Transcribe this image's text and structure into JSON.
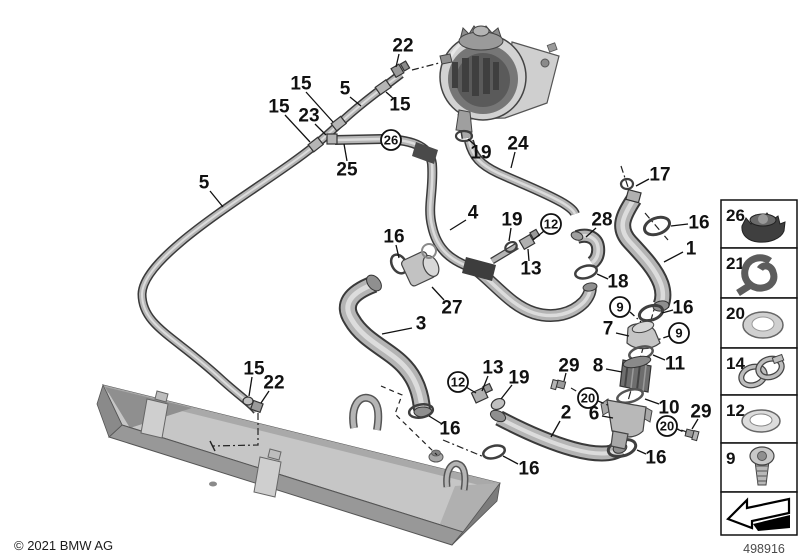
{
  "footer": {
    "copyright": "© 2021 BMW AG",
    "diagram_number": "498916"
  },
  "sidebar": {
    "items": [
      {
        "number": "26",
        "part_icon": "sealing-cap-icon"
      },
      {
        "number": "21",
        "part_icon": "hose-wrap-icon"
      },
      {
        "number": "20",
        "part_icon": "gasket-ring-icon"
      },
      {
        "number": "14",
        "part_icon": "hose-clamp-icon"
      },
      {
        "number": "12",
        "part_icon": "o-ring-icon"
      },
      {
        "number": "9",
        "part_icon": "torx-screw-icon"
      }
    ],
    "nav_arrow_icon": "previous-diagram-arrow-icon"
  },
  "diagram": {
    "callouts": [
      {
        "t": "22",
        "x": 403,
        "y": 46,
        "l": [
          399,
          54,
          396,
          67
        ]
      },
      {
        "t": "15",
        "x": 301,
        "y": 84,
        "l": [
          306,
          92,
          333,
          122
        ]
      },
      {
        "t": "5",
        "x": 345,
        "y": 89,
        "l": [
          350,
          97,
          361,
          106
        ]
      },
      {
        "t": "15",
        "x": 400,
        "y": 105,
        "l": [
          394,
          99,
          386,
          92
        ]
      },
      {
        "t": "15",
        "x": 279,
        "y": 107,
        "l": [
          285,
          115,
          310,
          142
        ]
      },
      {
        "t": "23",
        "x": 309,
        "y": 116,
        "l": [
          315,
          124,
          326,
          135
        ]
      },
      {
        "t": "26",
        "x": 391,
        "y": 140,
        "c": true
      },
      {
        "t": "25",
        "x": 347,
        "y": 170,
        "l": [
          347,
          161,
          344,
          144
        ]
      },
      {
        "t": "5",
        "x": 204,
        "y": 183,
        "l": [
          210,
          191,
          223,
          207
        ]
      },
      {
        "t": "19",
        "x": 481,
        "y": 153,
        "l": [
          476,
          146,
          468,
          139
        ]
      },
      {
        "t": "24",
        "x": 518,
        "y": 144,
        "l": [
          515,
          152,
          511,
          168
        ]
      },
      {
        "t": "17",
        "x": 660,
        "y": 175,
        "l": [
          649,
          179,
          636,
          186
        ]
      },
      {
        "t": "4",
        "x": 473,
        "y": 213,
        "l": [
          466,
          220,
          450,
          230
        ]
      },
      {
        "t": "19",
        "x": 512,
        "y": 220,
        "l": [
          511,
          228,
          509,
          241
        ]
      },
      {
        "t": "12",
        "x": 551,
        "y": 224,
        "c": true,
        "l": [
          544,
          231,
          533,
          240
        ]
      },
      {
        "t": "28",
        "x": 602,
        "y": 220,
        "l": [
          596,
          228,
          586,
          237
        ]
      },
      {
        "t": "16",
        "x": 699,
        "y": 223,
        "l": [
          688,
          224,
          671,
          226
        ]
      },
      {
        "t": "1",
        "x": 691,
        "y": 249,
        "l": [
          683,
          252,
          664,
          262
        ]
      },
      {
        "t": "13",
        "x": 531,
        "y": 269,
        "l": [
          529,
          261,
          528,
          249
        ]
      },
      {
        "t": "18",
        "x": 618,
        "y": 282,
        "l": [
          608,
          279,
          597,
          274
        ]
      },
      {
        "t": "16",
        "x": 394,
        "y": 237,
        "l": [
          396,
          245,
          399,
          258
        ]
      },
      {
        "t": "27",
        "x": 452,
        "y": 308,
        "l": [
          444,
          300,
          432,
          287
        ]
      },
      {
        "t": "9",
        "x": 620,
        "y": 307,
        "c": true,
        "d": [
          630,
          312,
          641,
          322
        ]
      },
      {
        "t": "16",
        "x": 683,
        "y": 308,
        "l": [
          673,
          310,
          662,
          313
        ]
      },
      {
        "t": "7",
        "x": 608,
        "y": 329,
        "l": [
          616,
          333,
          629,
          336
        ]
      },
      {
        "t": "9",
        "x": 679,
        "y": 333,
        "c": true,
        "d": [
          669,
          336,
          657,
          340
        ]
      },
      {
        "t": "3",
        "x": 421,
        "y": 324,
        "l": [
          412,
          328,
          382,
          334
        ]
      },
      {
        "t": "29",
        "x": 569,
        "y": 366,
        "l": [
          566,
          373,
          564,
          381
        ]
      },
      {
        "t": "8",
        "x": 598,
        "y": 366,
        "l": [
          606,
          369,
          622,
          372
        ]
      },
      {
        "t": "11",
        "x": 675,
        "y": 364,
        "l": [
          665,
          360,
          653,
          355
        ]
      },
      {
        "t": "20",
        "x": 588,
        "y": 398,
        "c": true,
        "d": [
          598,
          401,
          610,
          406
        ]
      },
      {
        "t": "10",
        "x": 669,
        "y": 408,
        "l": [
          659,
          404,
          645,
          399
        ]
      },
      {
        "t": "2",
        "x": 566,
        "y": 413,
        "l": [
          560,
          421,
          551,
          437
        ]
      },
      {
        "t": "6",
        "x": 594,
        "y": 414,
        "l": [
          602,
          416,
          613,
          418
        ]
      },
      {
        "t": "29",
        "x": 701,
        "y": 412,
        "l": [
          698,
          419,
          692,
          429
        ]
      },
      {
        "t": "20",
        "x": 667,
        "y": 426,
        "c": true,
        "d": [
          677,
          429,
          686,
          433
        ]
      },
      {
        "t": "16",
        "x": 656,
        "y": 458,
        "l": [
          646,
          454,
          637,
          450
        ]
      },
      {
        "t": "15",
        "x": 254,
        "y": 369,
        "l": [
          252,
          377,
          249,
          396
        ]
      },
      {
        "t": "22",
        "x": 274,
        "y": 383,
        "l": [
          269,
          391,
          261,
          403
        ]
      },
      {
        "t": "12",
        "x": 458,
        "y": 382,
        "c": true,
        "l": [
          466,
          387,
          476,
          393
        ]
      },
      {
        "t": "13",
        "x": 493,
        "y": 368,
        "l": [
          488,
          376,
          482,
          391
        ]
      },
      {
        "t": "19",
        "x": 519,
        "y": 378,
        "l": [
          512,
          385,
          501,
          399
        ]
      },
      {
        "t": "16",
        "x": 450,
        "y": 429,
        "l": [
          442,
          424,
          429,
          416
        ]
      },
      {
        "t": "16",
        "x": 529,
        "y": 469,
        "l": [
          518,
          464,
          503,
          456
        ]
      }
    ]
  }
}
